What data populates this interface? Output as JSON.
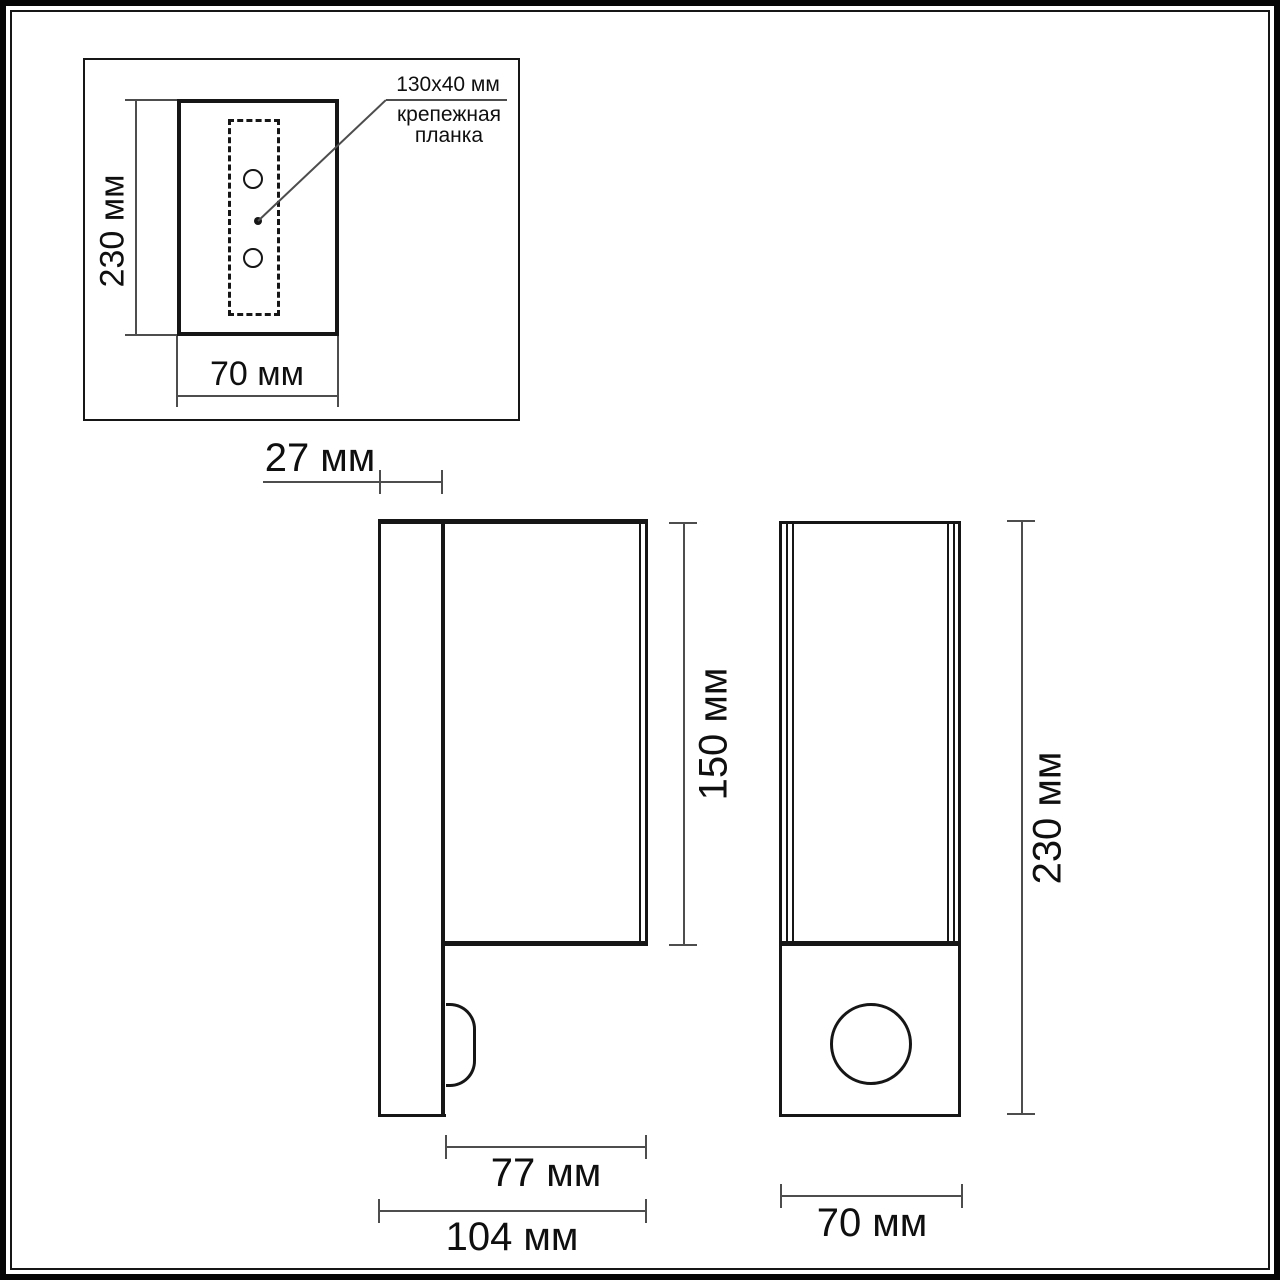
{
  "colors": {
    "line": "#161616",
    "dimension_line": "#4d4d4d",
    "background": "#ffffff"
  },
  "inset": {
    "mount_size_label": "130x40 мм",
    "mount_plate_label": "крепежная планка",
    "height_label": "230 мм",
    "width_label": "70 мм"
  },
  "side_view": {
    "plate_depth_label": "27 мм",
    "body_height_label": "150 мм",
    "body_depth_label": "77 мм",
    "total_depth_label": "104 мм"
  },
  "front_view": {
    "height_label": "230 мм",
    "width_label": "70 мм"
  }
}
